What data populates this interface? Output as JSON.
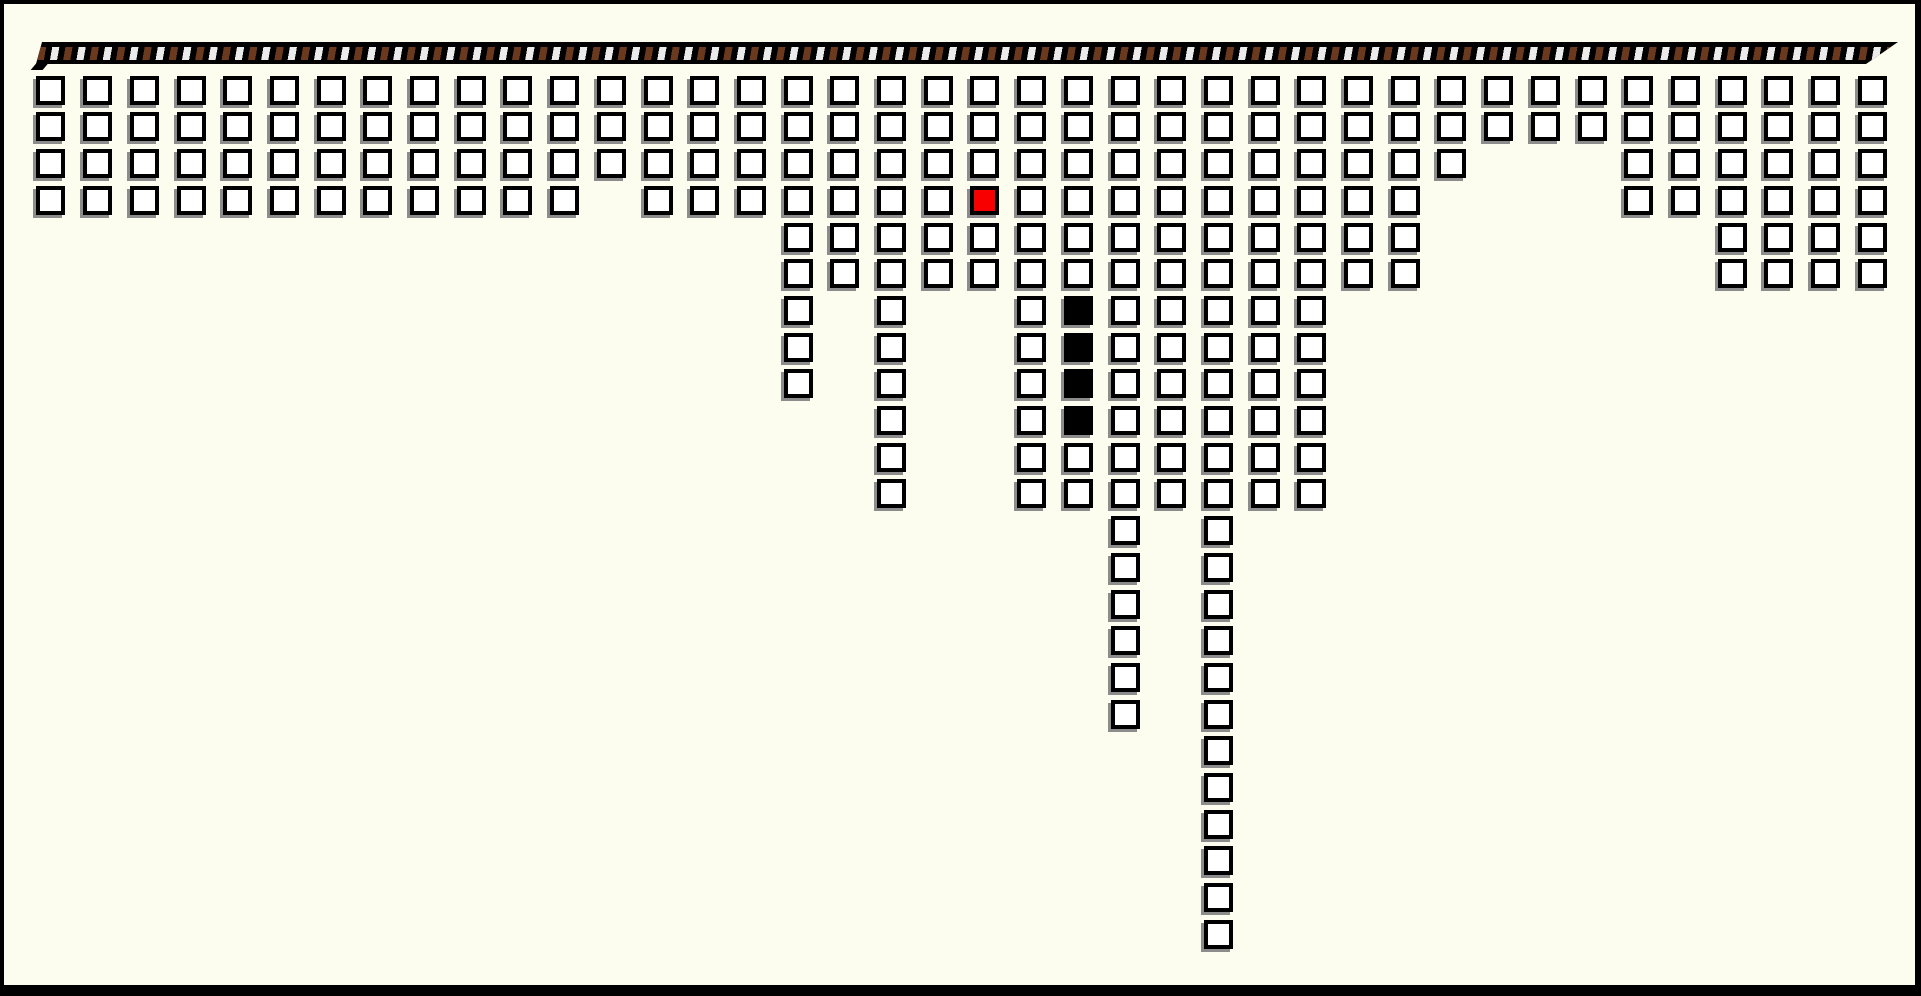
{
  "canvas": {
    "background_color": "#FDFDEF",
    "frame_color": "#000000"
  },
  "rope": {
    "description": "horizontal striped rope bar at top",
    "base_color": "#000000",
    "stripe_brown_color": "#6B3A1E",
    "stripe_white_color": "#EBEBEB"
  },
  "grid": {
    "num_columns": 40,
    "max_column_height": 24,
    "cell_fill_color": "#FFFFFF",
    "cell_border_color": "#000000",
    "cell_shadow_color": "#8C8C8C",
    "red_cell_color": "#F90000",
    "black_cell_color": "#000000",
    "column_heights": [
      4,
      4,
      4,
      4,
      4,
      4,
      4,
      4,
      4,
      4,
      4,
      4,
      3,
      4,
      4,
      4,
      9,
      6,
      12,
      6,
      6,
      12,
      12,
      18,
      12,
      24,
      12,
      12,
      6,
      6,
      3,
      2,
      2,
      2,
      4,
      4,
      6,
      6,
      6,
      6
    ],
    "special_cells": [
      {
        "column": 20,
        "row": 4,
        "type": "red"
      },
      {
        "column": 22,
        "row": 7,
        "type": "black"
      },
      {
        "column": 22,
        "row": 8,
        "type": "black"
      },
      {
        "column": 22,
        "row": 9,
        "type": "black"
      },
      {
        "column": 22,
        "row": 10,
        "type": "black"
      }
    ]
  }
}
